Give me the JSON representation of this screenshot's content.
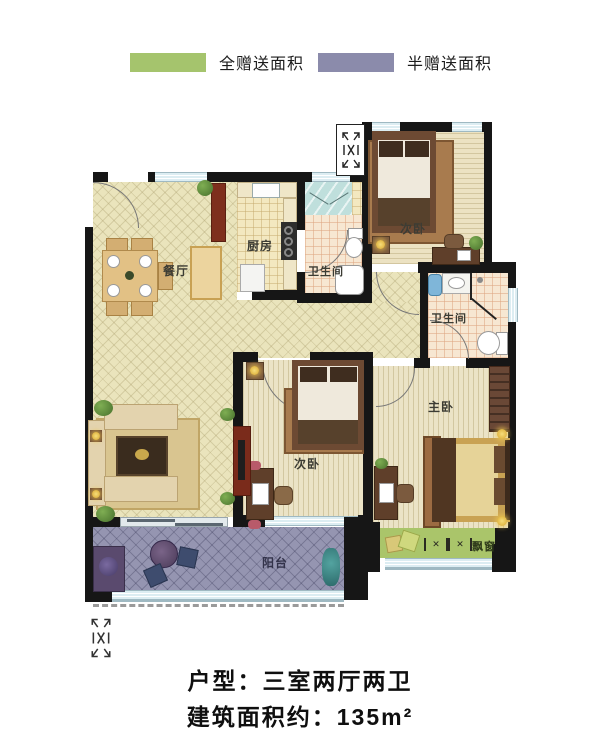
{
  "legend": {
    "items": [
      {
        "label": "全赠送面积",
        "color": "#a5c46d"
      },
      {
        "label": "半赠送面积",
        "color": "#8b8bab"
      }
    ]
  },
  "plan": {
    "rooms": {
      "dining": "餐厅",
      "kitchen": "厨房",
      "bathroom1": "卫生间",
      "bathroom2": "卫生间",
      "bedroom_top": "次卧",
      "bedroom_mid": "次卧",
      "master_bedroom": "主卧",
      "balcony": "阳台",
      "bay_window": "飘窗"
    },
    "colors": {
      "wall": "#161616",
      "balcony_floor": "#9595b1",
      "bay_window_area": "#aac56a"
    }
  },
  "footer": {
    "layout_line": "户型：三室两厅两卫",
    "area_line": "建筑面积约：135m²"
  }
}
